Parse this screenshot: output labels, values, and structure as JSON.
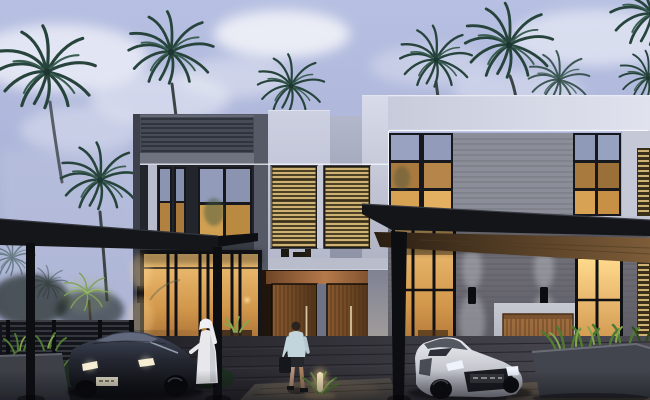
{
  "scene": {
    "description": "Dusk architectural rendering of a row of modern two-storey townhouse villas with warm interior lighting, LED facade strips, wood louver screens, dark carport canopies, two sports cars, palm trees and landscaped planters",
    "time_of_day": "dusk",
    "objects": [
      "sky",
      "clouds",
      "palm-trees",
      "townhouse-left-dark",
      "townhouse-center-entrance",
      "townhouse-right-white",
      "wood-louver-windows",
      "balcony",
      "entrance-doors",
      "led-strip-lighting",
      "horizontal-siding-panels",
      "carport-canopy-left",
      "carport-canopy-right",
      "canopy-posts",
      "dark-sports-car",
      "white-sports-car",
      "man-in-white-kandura",
      "man-walking-with-bag",
      "wood-garage-door",
      "wall-sconces",
      "path-bollard-light",
      "garden-fence",
      "shrubs",
      "planter-box-left",
      "planter-box-right",
      "wood-deck-driveway",
      "walkway"
    ]
  },
  "palette": {
    "skyTop": "#b7c0e2",
    "skyMid": "#a9b1d6",
    "skyBottom": "#99a1c6",
    "cloud": "#edeff7",
    "palmFrond": "#26433c",
    "palmFrondLight": "#3a5e52",
    "palmTrunk": "#3c4447",
    "palmLit": "#7da055",
    "leftFacade": "#565a66",
    "louverBand": "#474b56",
    "louverBandLine": "#30343e",
    "pillarLight": "#b8bccd",
    "pillarDim": "#8d91a4",
    "ledWhite": "#f7f9ff",
    "windowFrame": "#16181e",
    "glassSky": "#97a1c0",
    "glassWarm": "#d9a558",
    "glassWarmDeep": "#8a5326",
    "whiteParapet": "#d0d3e2",
    "slabBand": "#c0c3d3",
    "sidingUpper": "#8b8d99",
    "sidingLine": "#74767f",
    "sidingLower": "#6e6d77",
    "woodSlat": "#cdb273",
    "woodSlatGap": "#3a2f1a",
    "doorWood": "#6e4724",
    "doorGrain": "#4a2f16",
    "doorSoffit": "#b5794a",
    "garageWood": "#94653a",
    "garageGrain": "#6b4524",
    "canopyDark": "#15161a",
    "canopyWoodUnderside": "#7d5c38",
    "postDark": "#0d0e12",
    "deckDark": "#1b1b20",
    "deckLight": "#4b4951",
    "walkwayLight": "#58534e",
    "plankLine": "#17171c",
    "fenceDark": "#13151a",
    "fenceSlat": "#383b43",
    "shrubDark": "#1d2f20",
    "shrubLit": "#557239",
    "planterBox": "#42454d",
    "plantGreen": "#4e7a32",
    "plantLit": "#83a74e",
    "carDark": "#101118",
    "carDarkTop": "#434a5c",
    "carWhite": "#d9dade",
    "carWhiteShade": "#9b9da8",
    "headlight": "#f6eed6",
    "plateLight": "#ddd7c1",
    "plateDark": "#33343a",
    "robeWhite": "#e8e8ec",
    "skin": "#c9a584",
    "hair": "#2b241e",
    "shirtBlue": "#c2d5dd",
    "shortsDark": "#25272d",
    "bagDark": "#16171c",
    "glowWarm": "#ffd998",
    "sconceBody": "#0c0d10"
  }
}
